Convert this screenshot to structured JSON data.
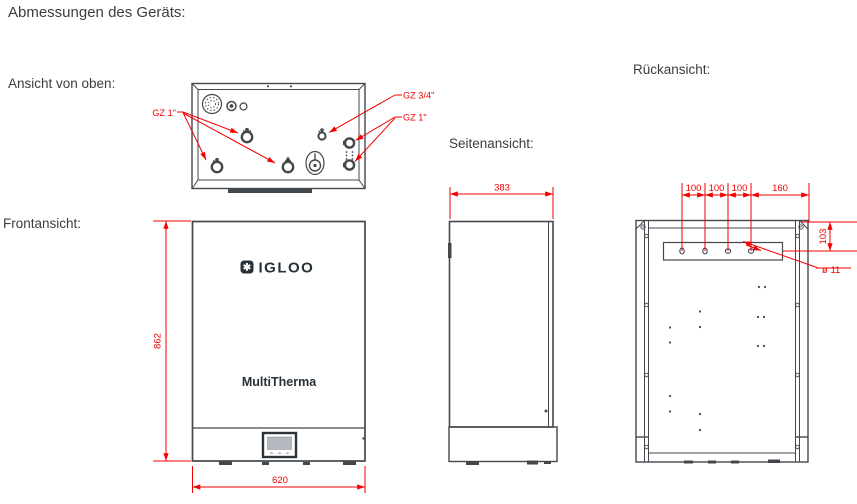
{
  "title": "Abmessungen des Geräts:",
  "views": {
    "top": {
      "label": "Ansicht von oben:"
    },
    "front": {
      "label": "Frontansicht:",
      "brand": "IGLOO",
      "logo_glyph": "✱",
      "model": "MultiTherma",
      "dim_height": "862",
      "dim_width": "620"
    },
    "side": {
      "label": "Seitenansicht:",
      "dim_depth": "383"
    },
    "rear": {
      "label": "Rückansicht:",
      "spacings": [
        "100",
        "100",
        "100",
        "160"
      ],
      "dim_offset": "103",
      "dim_hole_diameter": "ø 11"
    }
  },
  "connections": {
    "left_group": "GZ 1\"",
    "top_middle": "GZ 3/4\"",
    "right_group": "GZ 1\""
  },
  "colors": {
    "dimension_red": "#f40000",
    "drawing_line": "#43484d",
    "logo_dark": "#273137",
    "screen_gray": "#b4bac0"
  }
}
